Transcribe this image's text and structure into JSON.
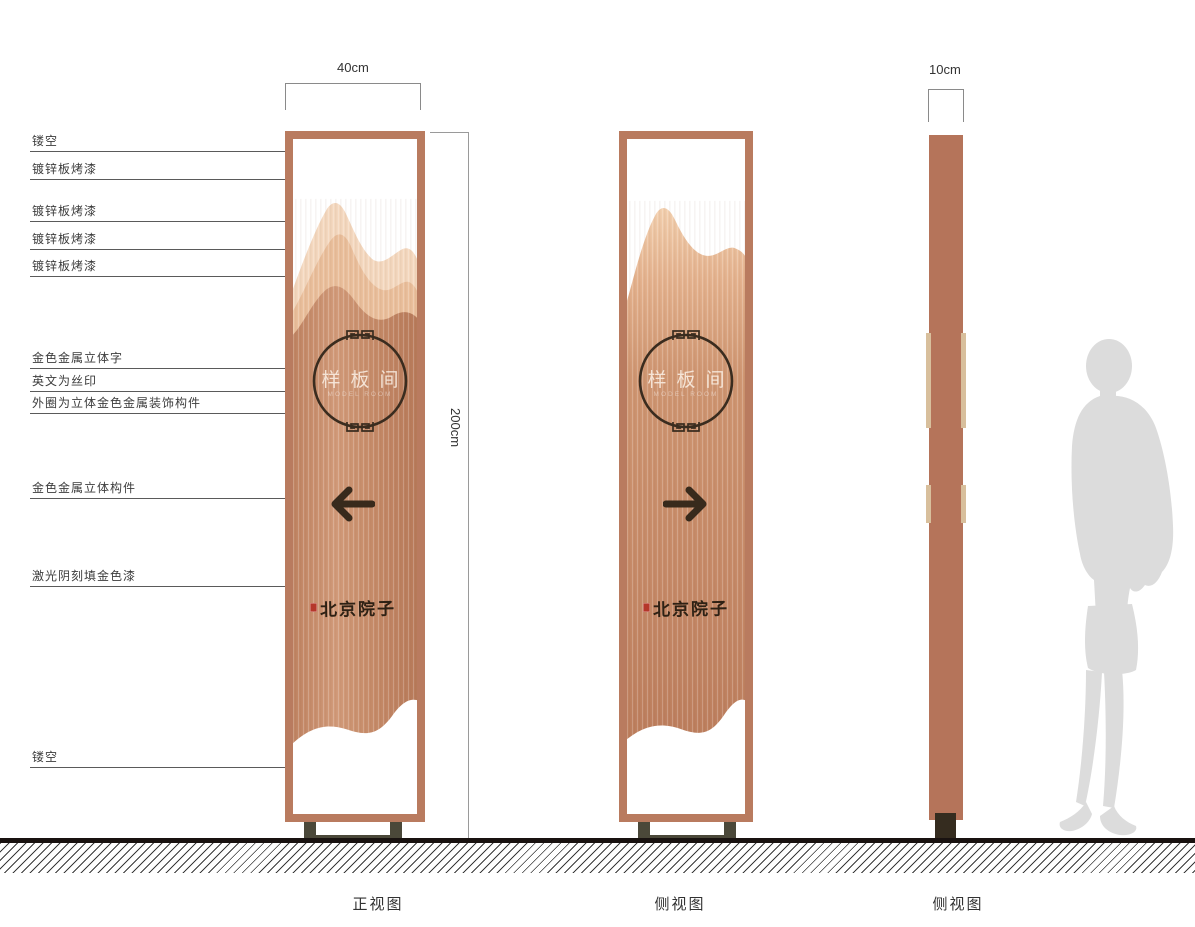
{
  "title": "signage-design-drawing",
  "dimensions": {
    "width": "40cm",
    "height": "200cm",
    "depth": "10cm"
  },
  "callouts": [
    {
      "label": "镂空"
    },
    {
      "label": "镀锌板烤漆"
    },
    {
      "label": "镀锌板烤漆"
    },
    {
      "label": "镀锌板烤漆"
    },
    {
      "label": "镀锌板烤漆"
    },
    {
      "label": "金色金属立体字"
    },
    {
      "label": "英文为丝印"
    },
    {
      "label": "外圈为立体金色金属装饰构件"
    },
    {
      "label": "金色金属立体构件"
    },
    {
      "label": "激光阴刻填金色漆"
    },
    {
      "label": "镂空"
    }
  ],
  "sign": {
    "circle_text": "样板间",
    "circle_subtext": "MODEL ROOM",
    "brand_text": "北京院子"
  },
  "views": {
    "front_label": "正视图",
    "side_label_1": "侧视图",
    "side_label_2": "侧视图"
  },
  "colors": {
    "frame": "#b97b5f",
    "panel": "#b5745a",
    "trim": "#d8bf9c",
    "stand": "#4b4839",
    "ink": "#3a2c1f",
    "seal_red": "#b5372a",
    "silhouette": "#dcdcdc",
    "mountain_light": "#f4d8bf",
    "mountain_mid": "#eabf9c",
    "copper_body": "#c98f6e"
  }
}
